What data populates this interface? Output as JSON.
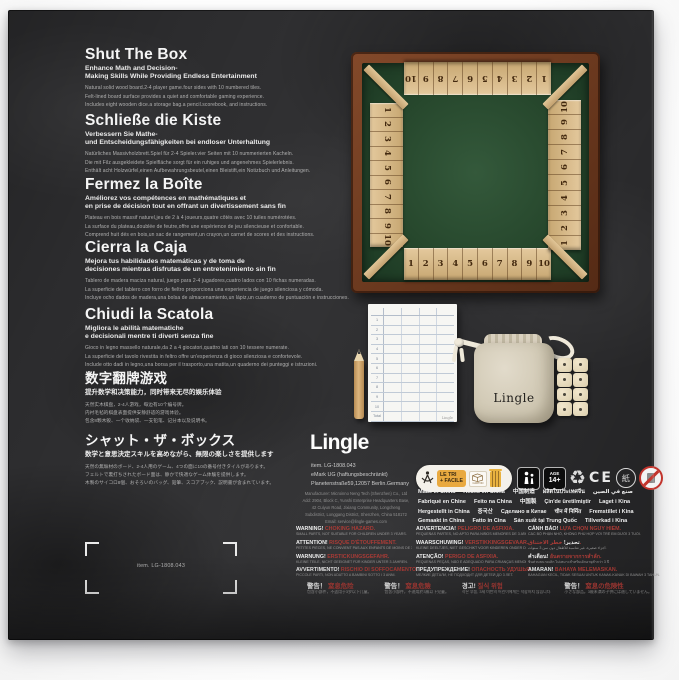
{
  "palette": {
    "slate": "#2c2c2e",
    "wood_frame": "#6e3b20",
    "wood_tile": "#d9bc8e",
    "felt_green": "#2d5133",
    "warning_red": "#a93b36",
    "canvas_bag": "#d8d0bf",
    "triman_orange": "#e9a93f"
  },
  "sections": [
    {
      "title": "Shut The Box",
      "subtitle": [
        "Enhance Math and Decision-",
        "Making Skills While Providing Endless Entertainment"
      ],
      "body": [
        "Natural solid wood board.2-4 player game.four sides with 10 numbered tiles.",
        "Felt-lined board surface provides a quiet and comfortable gaming experience.",
        "Includes eight wooden dice.a storage bag.a pencil.scorebook, and instructions."
      ]
    },
    {
      "title": "Schließe die Kiste",
      "subtitle": [
        "Verbessern Sie Mathe-",
        "und Entscheidungsfähigkeiten bei endloser Unterhaltung"
      ],
      "body": [
        "Natürliches Massivholzbrett.Spiel für 2-4 Spieler.vier Seiten mit 10 nummerierten Kacheln.",
        "Die mit Filz ausgekleidete Spielfläche sorgt für ein ruhiges und angenehmes Spielerlebnis.",
        "Enthält acht Holzwürfel,einen Aufbewahrungsbeutel,einen Bleistift,ein Notizbuch und Anleitungen."
      ]
    },
    {
      "title": "Fermez la Boîte",
      "subtitle": [
        "Améliorez vos compétences en mathématiques et",
        "en prise de décision tout en offrant un divertissement sans fin"
      ],
      "body": [
        "Plateau en bois massif naturel,jeu de 2 à 4 joueurs,quatre côtés avec 10 tuiles numérotées.",
        "La surface du plateau,doublée de feutre,offre une expérience de jeu silencieuse et confortable.",
        "Comprend huit dés en bois,un sac de rangement,un crayon,un carnet de scores et des instructions."
      ]
    },
    {
      "title": "Cierra la Caja",
      "subtitle": [
        "Mejora tus habilidades matemáticas y de toma de",
        "decisiones mientras disfrutas de un entretenimiento sin fin"
      ],
      "body": [
        "Tablero de madera maciza natural, juego para 2-4 jugadores,cuatro lados con 10 fichas numeradas.",
        "La superficie del tablero con forro de fieltro proporciona una experiencia de juego silenciosa y cómoda.",
        "Incluye ocho dados de madera,una bolsa de almacenamiento,un lápiz,un cuaderno de puntuación e instrucciones."
      ]
    },
    {
      "title": "Chiudi la Scatola",
      "subtitle": [
        "Migliora le abilità matematiche",
        "e decisionali mentre ti diverti senza fine"
      ],
      "body": [
        "Gioco in legno massello naturale,da 2 a 4 giocatori,quattro lati con 10 tessere numerate.",
        "La superficie del tavolo rivestita in feltro offre un'esperienza di gioco silenziosa e confortevole.",
        "Include otto dadi in legno,una borsa per il trasporto,una matita,un quaderno dei punteggi e istruzioni."
      ]
    },
    {
      "title": "数字翻牌游戏",
      "subtitle": [
        "提升数学和决策能力，同时带来无尽的娱乐体验"
      ],
      "body": [
        "天然实木棋盘，2-4人游戏，每边有10个编号牌。",
        "内衬毛毡的棋盘表面提供安静舒适的游戏体验。",
        "包含8颗木骰、一个收纳袋、一支铅笔、记分本以及说明书。"
      ]
    },
    {
      "title": "シャット・ザ・ボックス",
      "subtitle": [
        "数学と意思決定スキルを高めながら、無限の楽しさを提供します"
      ],
      "body": [
        "天然の無垢材のボード、2-4人用のゲーム、4つの面に10の番号付きタイルがあります。",
        "フェルトで裏打ちされたボード面は、静かで快適なゲーム体験を提供します。",
        "木製のサイコロ8個、おそろいのバッグ、鉛筆、スコアブック、説明書が含まれています。"
      ]
    }
  ],
  "board": {
    "tiles": [
      "1",
      "2",
      "3",
      "4",
      "5",
      "6",
      "7",
      "8",
      "9",
      "10"
    ],
    "tiles_desc": [
      "10",
      "9",
      "8",
      "7",
      "6",
      "5",
      "4",
      "3",
      "2",
      "1"
    ]
  },
  "scorepad": {
    "rows": [
      "1",
      "2",
      "3",
      "4",
      "5",
      "6",
      "7",
      "8",
      "9",
      "10",
      "Total"
    ],
    "brand": "Lingle"
  },
  "bag": {
    "label": "Lingle"
  },
  "brand": {
    "logo": "Lingle",
    "item": "item. LG-1808.043",
    "company": "eMark UG (haftungsbeschränkt)",
    "address": "Planetenstraße59,12057 Berlin.Germany",
    "manufacturer": [
      "Manufacturer: Microinno Neng Tech (Shenzhen) Co., Ltd",
      "Add: 2904, Block C, Yunshi Enterprise Headquarters Base,",
      "42 Cuiyun Road, Jixiang Community, Longcheng",
      "Subdistrict, Longgang District, Shenzhen, China 518172",
      "Email: service@lingle-games.com"
    ]
  },
  "triman": {
    "line1": "LE TRI",
    "line2": "+ FACILE",
    "carton": "CARTON"
  },
  "badges": {
    "age_line1": "AGE",
    "age_line2": "14+",
    "recycle": "♻",
    "ce": "CE",
    "paper": "紙"
  },
  "made_in": {
    "row1": [
      "Made in China",
      "Hecho en China",
      "中国制造",
      "ผลิตในประเทศจีน",
      "صنع في الصين"
    ],
    "row2": [
      "Fabriqué en Chine",
      "Feito na China",
      "中国製",
      "Çin'de üretilmiştir",
      "Laget i Kina"
    ],
    "row3": [
      "Hergestellt in China",
      "중국산",
      "Сделано в Китае",
      "चीन में निर्मित",
      "Fremstillet i Kina"
    ],
    "row4": [
      "Gemaakt in China",
      "Fatto in Cina",
      "Sản xuất tại Trung Quốc",
      "Tillverkad i Kina"
    ]
  },
  "warnings": {
    "col1": [
      {
        "t": "WARNING!",
        "h": "CHOKING HAZARD.",
        "s": "SMALL PARTS, NOT SUITABLE FOR CHILDREN UNDER 3 YEARS."
      },
      {
        "t": "ATTENTION!",
        "h": "RISQUE D'ÉTOUFFEMENT.",
        "s": "PETITES PIÈCES, NE CONVIENT PAS AUX ENFANTS DE MOINS DE 3 ANS."
      },
      {
        "t": "WARNUNG!",
        "h": "ERSTICKUNGSGEFAHR.",
        "s": "KLEINE TEILE, NICHT GEEIGNET FÜR KINDER UNTER 3 JAHREN."
      },
      {
        "t": "AVVERTIMENTO!",
        "h": "RISCHIO DI SOFFOCAMENTO.",
        "s": "PICCOLE PARTI, NON ADATTO A BAMBINI SOTTO I 3 ANNI."
      }
    ],
    "col2": [
      {
        "t": "ADVERTENCIA!",
        "h": "PELIGRO DE ASFIXIA.",
        "s": "PEQUEÑAS PARTES, NO APTO PARA NIÑOS MENORES DE 3 AÑOS."
      },
      {
        "t": "WAARSCHUWING!",
        "h": "VERSTIKKINGSGEVAAR.",
        "s": "KLEINE DEELTJES, NIET GESCHIKT VOOR KINDEREN ONDER DE 3 JAAR."
      },
      {
        "t": "ATENÇÃO!",
        "h": "PERIGO DE ASFIXIA.",
        "s": "PEQUENAS PEÇAS, NÃO É ADEQUADO PARA CRIANÇAS MENORES DE 3 ANOS."
      },
      {
        "t": "ПРЕДУПРЕЖДЕНИЕ!",
        "h": "ОПАСНОСТЬ УДУШЬЯ.",
        "s": "МЕЛКИЕ ДЕТАЛИ, НЕ ПОДХОДИТ ДЛЯ ДЕТЕЙ ДО 3 ЛЕТ."
      }
    ],
    "col3": [
      {
        "t": "CẢNH BÁO!",
        "h": "LỰA CHỌN NGUY HIỂM.",
        "s": "CÁC BỘ PHẬN NHỎ, KHÔNG PHÙ HỢP VỚI TRẺ EM DƯỚI 3 TUỔI."
      },
      {
        "t": "تحذير!",
        "h": "خطر الاختناق.",
        "s": "أجزاء صغيرة، غير مناسبة للأطفال دون سن 3 سنوات."
      },
      {
        "t": "คำเตือน!",
        "h": "อันตรายจากการสำลัก.",
        "s": "ชิ้นส่วนขนาดเล็ก ไม่เหมาะสำหรับเด็กอายุต่ำกว่า 3 ปี"
      },
      {
        "t": "AMARAN!",
        "h": "BAHAYA MELEMASKAN.",
        "s": "BAHAGIAN KECIL, TIDAK SESUAI UNTUK KANAK-KANAK DI BAWAH 3 TAHUN."
      }
    ],
    "cjk": [
      {
        "t": "警告！",
        "h": "窒息危险",
        "s": "包含小部件，不适用于3岁以下儿童。"
      },
      {
        "t": "警告！",
        "h": "窒息危險",
        "s": "包含小部件，不適用於3歲以下兒童。"
      },
      {
        "t": "경고!",
        "h": "질식 위험",
        "s": "작은 부품, 3세 미만의 어린이에게는 적합하지 않습니다."
      },
      {
        "t": "警告！",
        "h": "窒息の危険性",
        "s": "小さな部品。3歳未満の子供には適していません。"
      }
    ]
  },
  "cropmark": {
    "label": "item. LG-1808.043"
  }
}
